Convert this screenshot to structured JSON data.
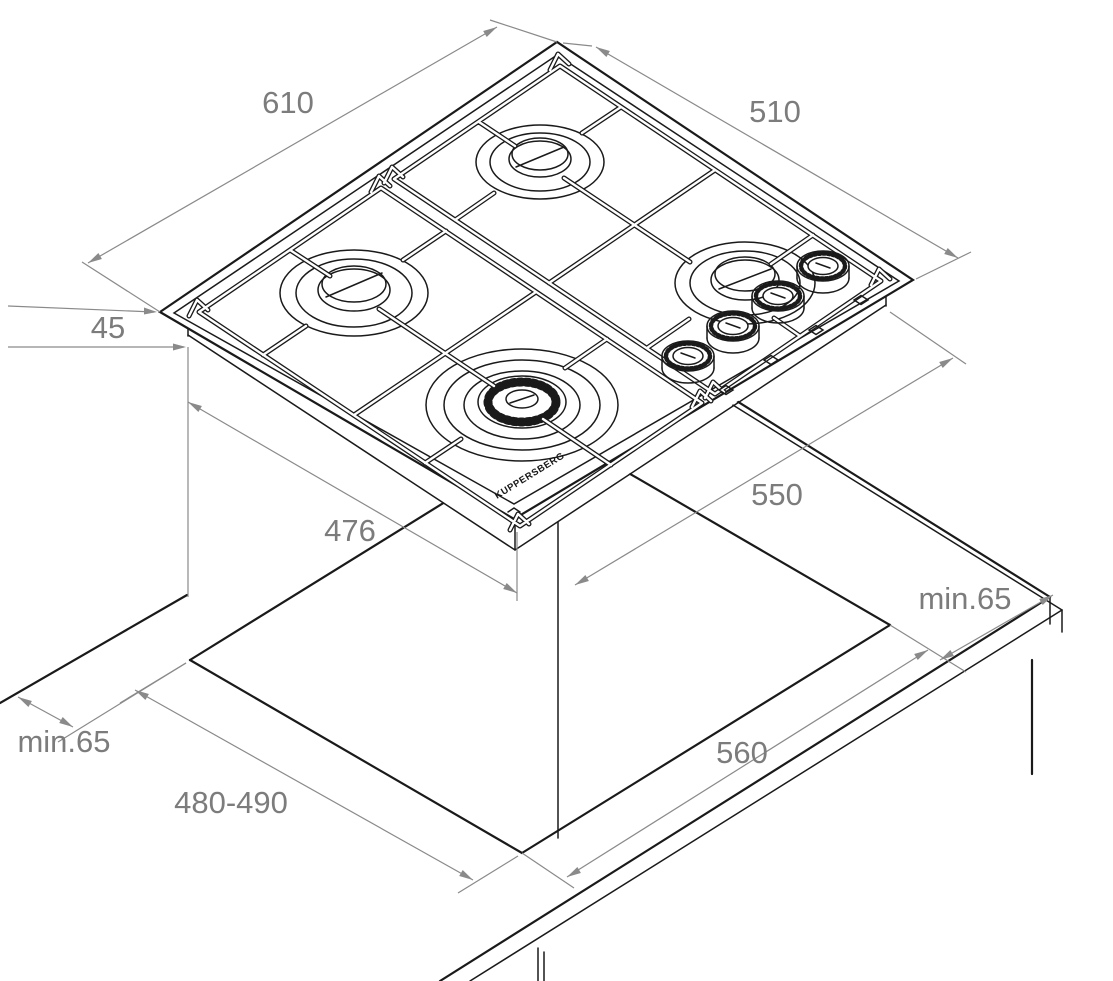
{
  "diagram": {
    "product": "built-in 4-burner gas hob",
    "view": "isometric installation drawing with worktop cutout",
    "brand_label": "KUPPERSBERG",
    "dimensions": {
      "hob_width": "610",
      "hob_depth": "510",
      "hob_height": "45",
      "hob_body_width": "476",
      "worktop_depth_to_cutout": "550",
      "cutout_width": "560",
      "cutout_depth": "480-490",
      "rear_clearance": "min.65",
      "side_clearance": "min.65"
    },
    "colors": {
      "line": "#1a1a1a",
      "dimension": "#8a8a8a",
      "label": "#7c7c7c",
      "background": "#ffffff"
    }
  }
}
